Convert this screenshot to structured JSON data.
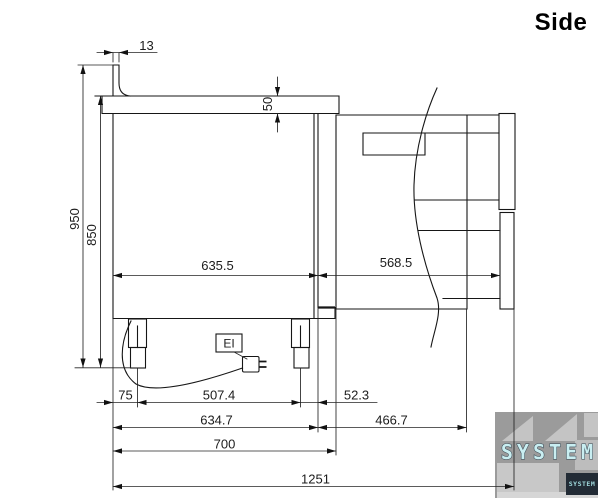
{
  "title": "Side",
  "dimensions": {
    "backsplash_width": "13",
    "worktop_thickness": "50",
    "overall_height": "950",
    "worktop_height": "850",
    "counter_depth_top": "635.5",
    "rear_unit_depth": "568.5",
    "front_to_leg": "75",
    "leg_spacing": "507.4",
    "leg_to_back": "52.3",
    "counter_depth_base": "634.7",
    "rear_extension": "466.7",
    "base_depth": "700",
    "overall_depth": "1251"
  },
  "labels": {
    "electrical_connection": "EI"
  },
  "watermark": {
    "logo_text": "SYSTEM",
    "badge_text": "SYSTEM",
    "logo_color": "#c9eef1"
  }
}
